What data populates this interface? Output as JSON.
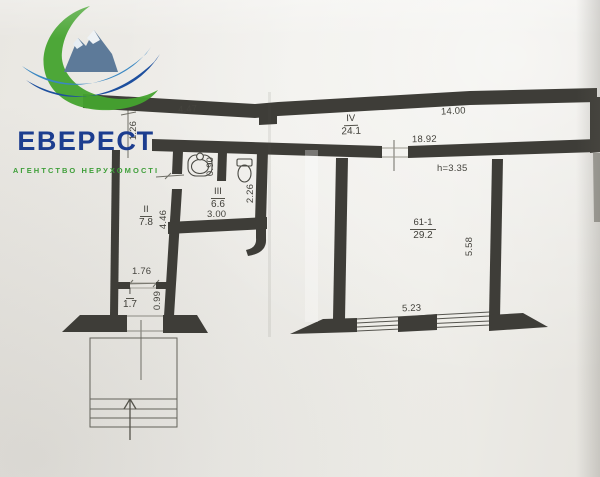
{
  "logo": {
    "title": "ЕВЕРЕСТ",
    "subtitle": "АГЕНТСТВО НЕРУХОМОСТІ",
    "icon": "mountain-logo"
  },
  "floor_plan": {
    "rooms": {
      "hall": {
        "label": "I",
        "area": "1.7"
      },
      "room2": {
        "label": "II",
        "area": "7.8"
      },
      "bathroom": {
        "label": "III",
        "area": "6.6"
      },
      "corridor": {
        "label": "IV",
        "area": "24.1"
      },
      "main_room": {
        "label": "61-1",
        "area": "29.2"
      }
    },
    "dimensions": {
      "top_left": "4.47",
      "top_right": "14.00",
      "corridor_left": "1.26",
      "corridor_door": "18.92",
      "ceiling_height": "h=3.35",
      "bath_partition": "0.90",
      "bath_width": "3.00",
      "bath_depth": "2.26",
      "room2_depth": "4.46",
      "hall_width": "1.76",
      "hall_depth": "0.99",
      "main_room_depth": "5.58",
      "main_room_width": "5.23"
    },
    "icons": {
      "sink": "sink-icon",
      "toilet": "toilet-icon",
      "stairs": "stairs-up-arrow-icon"
    }
  },
  "colors": {
    "wall": "#3e3d38",
    "thin_line": "#55544c",
    "logo_blue": "#1c3d8f",
    "logo_green": "#3f9f3a",
    "paper": "#efeeea"
  }
}
